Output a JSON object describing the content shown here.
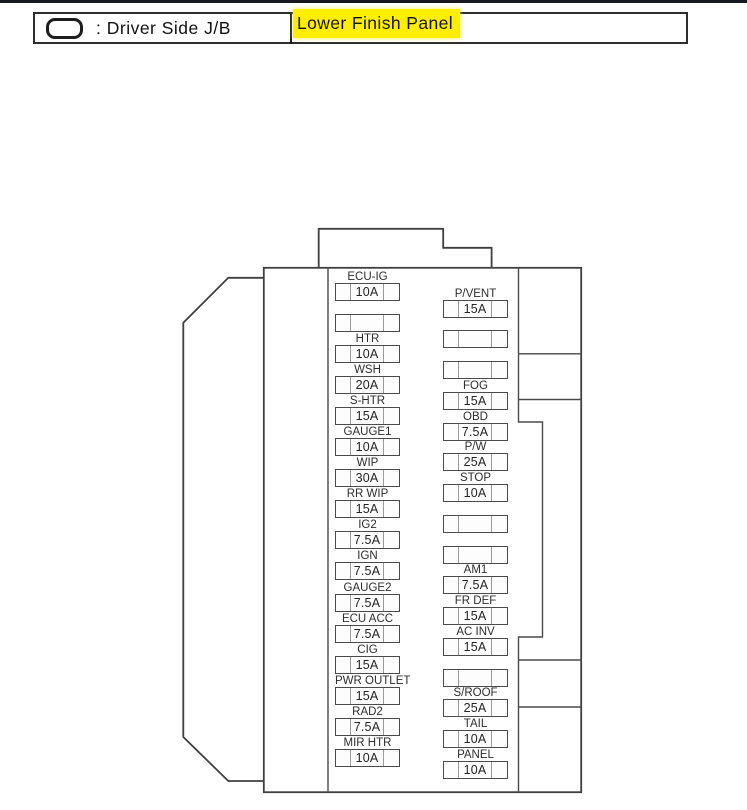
{
  "header": {
    "symbol_icon": "driver-side-junction-block-oval",
    "label": ": Driver Side J/B",
    "highlight_text": "Lower Finish Panel",
    "highlight_color": "#ffee00"
  },
  "fusebox": {
    "name": "Driver Side J/B (Lower Finish Panel) fuse layout",
    "left_column": [
      {
        "label": "ECU-IG",
        "amp": "10A"
      },
      {
        "label": "",
        "amp": ""
      },
      {
        "label": "HTR",
        "amp": "10A"
      },
      {
        "label": "WSH",
        "amp": "20A"
      },
      {
        "label": "S-HTR",
        "amp": "15A"
      },
      {
        "label": "GAUGE1",
        "amp": "10A"
      },
      {
        "label": "WIP",
        "amp": "30A"
      },
      {
        "label": "RR WIP",
        "amp": "15A"
      },
      {
        "label": "IG2",
        "amp": "7.5A"
      },
      {
        "label": "IGN",
        "amp": "7.5A"
      },
      {
        "label": "GAUGE2",
        "amp": "7.5A"
      },
      {
        "label": "ECU ACC",
        "amp": "7.5A"
      },
      {
        "label": "CIG",
        "amp": "15A"
      },
      {
        "label": "PWR OUTLET",
        "amp": "15A"
      },
      {
        "label": "RAD2",
        "amp": "7.5A"
      },
      {
        "label": "MIR HTR",
        "amp": "10A"
      }
    ],
    "right_column": [
      {
        "label": "P/VENT",
        "amp": "15A"
      },
      {
        "label": "",
        "amp": ""
      },
      {
        "label": "",
        "amp": ""
      },
      {
        "label": "FOG",
        "amp": "15A"
      },
      {
        "label": "OBD",
        "amp": "7.5A"
      },
      {
        "label": "P/W",
        "amp": "25A"
      },
      {
        "label": "STOP",
        "amp": "10A"
      },
      {
        "label": "",
        "amp": ""
      },
      {
        "label": "",
        "amp": ""
      },
      {
        "label": "AM1",
        "amp": "7.5A"
      },
      {
        "label": "FR DEF",
        "amp": "15A"
      },
      {
        "label": "AC INV",
        "amp": "15A"
      },
      {
        "label": "",
        "amp": ""
      },
      {
        "label": "S/ROOF",
        "amp": "25A"
      },
      {
        "label": "TAIL",
        "amp": "10A"
      },
      {
        "label": "PANEL",
        "amp": "10A"
      }
    ]
  },
  "colors": {
    "line": "#4a4a4a",
    "divider": "#9a9a9a",
    "text": "#2d2d2d",
    "highlight": "#ffee00",
    "top_rule": "#17171f"
  }
}
